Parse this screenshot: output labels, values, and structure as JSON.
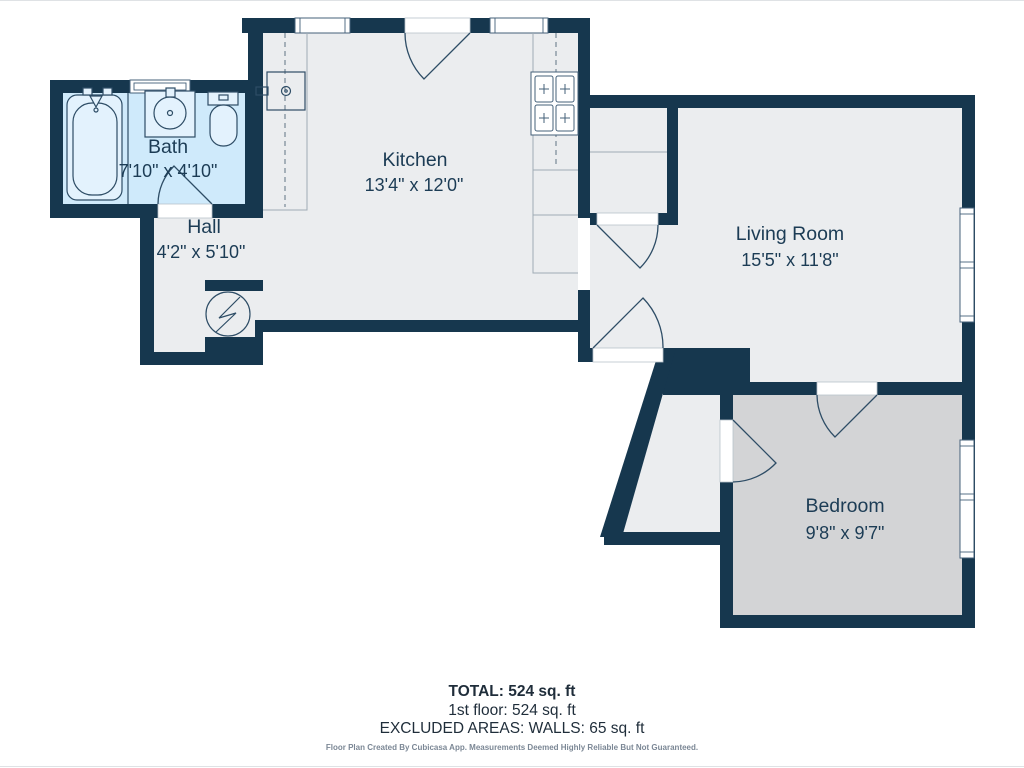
{
  "rooms": {
    "bath": {
      "name": "Bath",
      "dims": "7'10\" x 4'10\""
    },
    "hall": {
      "name": "Hall",
      "dims": "4'2\" x 5'10\""
    },
    "kitchen": {
      "name": "Kitchen",
      "dims": "13'4\" x 12'0\""
    },
    "living": {
      "name": "Living Room",
      "dims": "15'5\" x 11'8\""
    },
    "bedroom": {
      "name": "Bedroom",
      "dims": "9'8\" x 9'7\""
    }
  },
  "summary": {
    "total": "TOTAL: 524 sq. ft",
    "floor1": "1st floor: 524 sq. ft",
    "excluded": "EXCLUDED AREAS: WALLS: 65 sq. ft",
    "disclaimer": "Floor Plan Created By Cubicasa App. Measurements Deemed Highly Reliable But Not Guaranteed."
  },
  "colors": {
    "wall": "#16374e",
    "floor": "#ebedef",
    "bedroom_floor": "#d3d4d6",
    "bath_floor": "#cfeafb",
    "label_text": "#1c3c55",
    "summary_text": "#1f2d3a",
    "disclaimer_text": "#7b8795",
    "background": "#ffffff"
  }
}
